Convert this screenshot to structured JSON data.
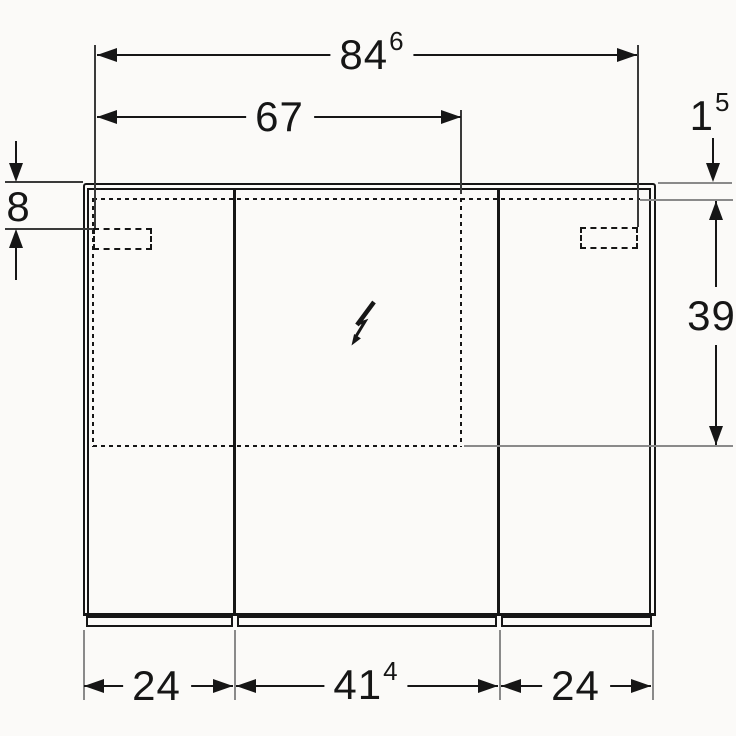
{
  "page": {
    "background": "#fbfaf8",
    "ink": "#161616",
    "witness_color": "#8a8a8a",
    "description": "technical front-view dimension drawing of a three-door mirror cabinet with electrical connection symbol"
  },
  "dimensions": {
    "overall_top_width": {
      "main": "84",
      "sup": "6"
    },
    "inner_recess_width": {
      "main": "67",
      "sup": ""
    },
    "top_edge_gap": {
      "main": "1",
      "sup": "5"
    },
    "bracket_top_offset": {
      "main": "8",
      "sup": ""
    },
    "recess_height": {
      "main": "39",
      "sup": ""
    },
    "left_door_width": {
      "main": "24",
      "sup": ""
    },
    "middle_door_width": {
      "main": "41",
      "sup": "4"
    },
    "right_door_width": {
      "main": "24",
      "sup": ""
    }
  },
  "symbols": {
    "electrical_connection": "lightning-arrow"
  }
}
